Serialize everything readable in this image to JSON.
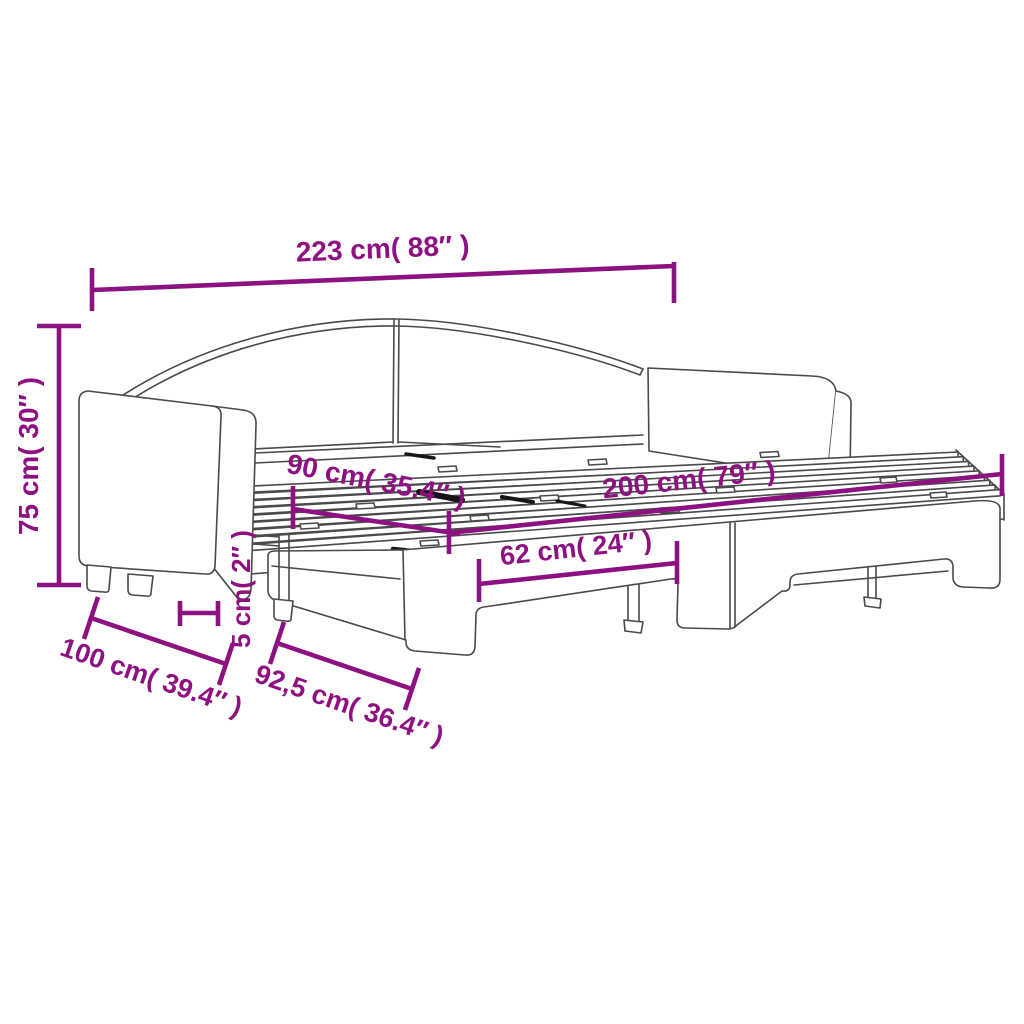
{
  "page": {
    "background": "#ffffff"
  },
  "diagram": {
    "title": "daybed-with-trundle-dimension-diagram",
    "accent_color": "#8E1181",
    "line_color": "#4a4a4a",
    "dark_mark_color": "#161616",
    "dimensions": {
      "overall_length": {
        "label": "223 cm( 88″ )",
        "cm": "223",
        "inch": "88"
      },
      "overall_height": {
        "label": "75 cm( 30″ )",
        "cm": "75",
        "inch": "30"
      },
      "slat_width": {
        "label": "90 cm( 35.4″ )",
        "cm": "90",
        "inch": "35.4"
      },
      "slat_length": {
        "label": "200 cm( 79″ )",
        "cm": "200",
        "inch": "79"
      },
      "trundle_recess": {
        "label": "62 cm( 24″ )",
        "cm": "62",
        "inch": "24"
      },
      "gap_height": {
        "label": "5 cm( 2″ )",
        "cm": "5",
        "inch": "2"
      },
      "overall_depth": {
        "label": "100 cm( 39.4″ )",
        "cm": "100",
        "inch": "39.4"
      },
      "trundle_depth": {
        "label": "92,5 cm( 36.4″ )",
        "cm": "92,5",
        "inch": "36.4"
      }
    }
  }
}
